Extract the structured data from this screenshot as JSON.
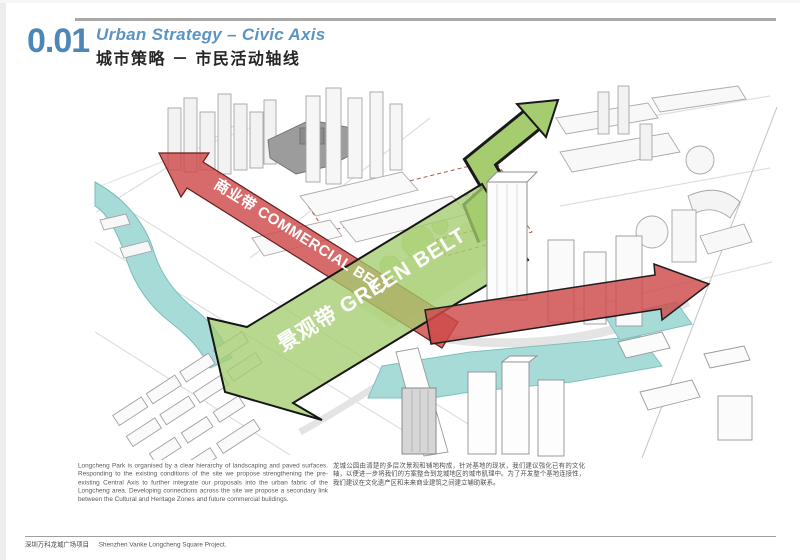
{
  "header": {
    "number": "0.01",
    "title_en": "Urban Strategy – Civic Axis",
    "title_cn": "城市策略 － 市民活动轴线",
    "accent_color": "#4d87b7"
  },
  "diagram": {
    "labels": {
      "commercial_belt": "商业带 COMMERCIAL BELT",
      "green_belt": "景观带 GREEN BELT"
    },
    "colors": {
      "belt_red": "#ce4a4a",
      "belt_green": "#a5cd70",
      "water": "#a6dbd8"
    }
  },
  "description": {
    "english": "Longcheng Park is organised by a clear hierarchy of landscaping and paved surfaces. Responding to the existing conditions of the site we propose strengthening the pre-existing Central Axis to further integrate our proposals into the urban fabric of the Longcheng area. Developing connections across the site we propose a secondary link between the Cultural and Heritage Zones and future commercial buildings.",
    "chinese": "龙城公园由清楚的多层次景观和铺地构成，针对基地的现状，我们建议强化已有的文化轴，以便进一步将我们的方案整合到龙城地区的城市肌理中。为了开发整个基地连接性，我们建议在文化遗产区和未来商业建筑之间建立辅助联系。"
  },
  "footer": {
    "project_cn": "深圳万科龙城广场项目",
    "project_en": "Shenzhen Vanke Longcheng Square Project."
  }
}
